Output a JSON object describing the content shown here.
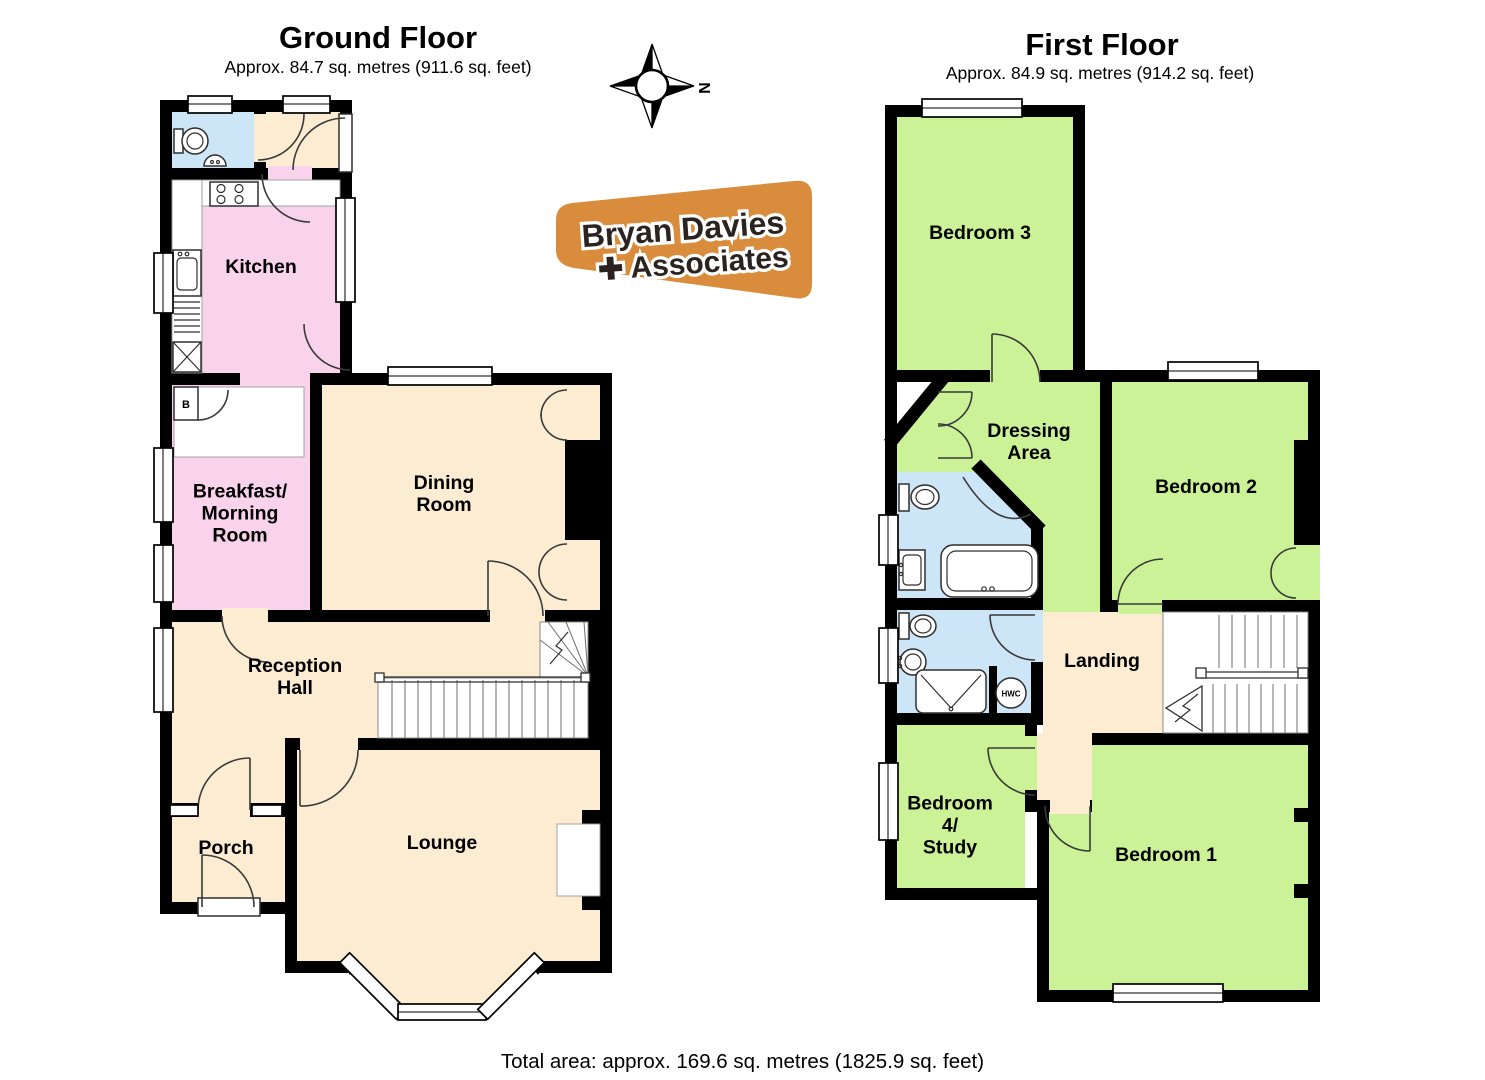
{
  "colors": {
    "wall": "#000000",
    "cream": "#fcecd1",
    "pink": "#f8d3eb",
    "green": "#cbf296",
    "blue": "#cde6f7",
    "line": "#3a3a3a",
    "logo_orange": "#d98d3c",
    "logo_text": "#2b2320"
  },
  "ground_floor": {
    "title": "Ground Floor",
    "area": "Approx. 84.7 sq. metres (911.6 sq. feet)",
    "rooms": {
      "kitchen": "Kitchen",
      "breakfast": "Breakfast/\nMorning\nRoom",
      "dining": "Dining\nRoom",
      "reception": "Reception\nHall",
      "porch": "Porch",
      "lounge": "Lounge"
    },
    "fixtures": {
      "boiler": "B"
    }
  },
  "first_floor": {
    "title": "First Floor",
    "area": "Approx. 84.9 sq. metres (914.2 sq. feet)",
    "rooms": {
      "bedroom3": "Bedroom 3",
      "dressing": "Dressing\nArea",
      "bedroom2": "Bedroom 2",
      "landing": "Landing",
      "bedroom4": "Bedroom\n4/\nStudy",
      "bedroom1": "Bedroom 1"
    },
    "fixtures": {
      "hwc": "HWC"
    }
  },
  "compass": {
    "north": "N"
  },
  "logo": {
    "line1": "Bryan Davies",
    "line2": "✚ Associates"
  },
  "footer": {
    "total": "Total area: approx. 169.6 sq. metres (1825.9 sq. feet)"
  }
}
